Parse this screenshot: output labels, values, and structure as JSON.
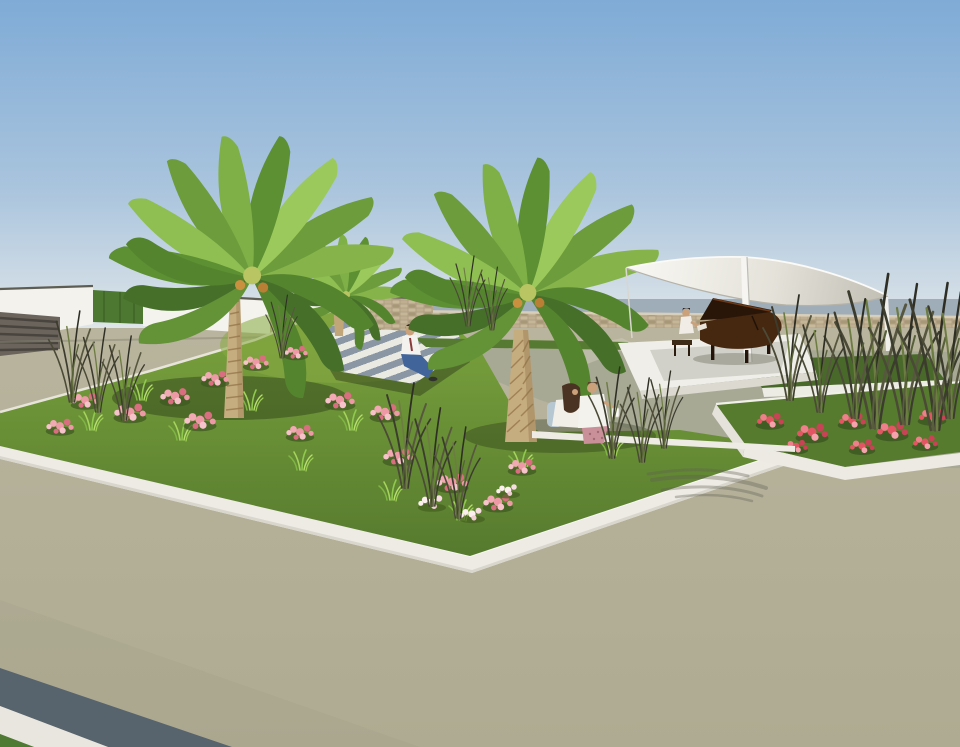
{
  "meta": {
    "kind": "3d-architectural-landscape-rendering",
    "setting": "Seaside public plaza with raised planters, palm trees and an open-air piano stage",
    "canvas": {
      "width": 960,
      "height": 747
    }
  },
  "palette": {
    "sky_top": "#7fabd6",
    "sky_horizon": "#e3e8ea",
    "sea": "#9fadb9",
    "wall_stone": "#b3a286",
    "pavement": "#b8b49d",
    "pavement_deep": "#afab92",
    "sage_ground": "#a7a995",
    "grass_light": "#7ca43e",
    "grass": "#567a2e",
    "grass_deep": "#49692a",
    "curb_white": "#edebe4",
    "curb_face": "#d9d7cd",
    "canopy_white": "#f7f6f1",
    "canopy_shadow": "#c3c0b6",
    "palm_trunk": "#c6ad80",
    "slate_band": "#57636d",
    "piano_brown": "#46270f",
    "hedge_green": "#4d7831",
    "building_white": "#f4f3ee",
    "step_light": "#ebeae2",
    "step_shadow": "#8b96a4",
    "flower_pink": "#ee9aa6",
    "flower_deep": "#d96e80",
    "flower_red": "#e25663",
    "flower_white": "#fdeef0",
    "skin": "#cba17b",
    "jeans": "#41659a",
    "backpack": "#b6c7d2",
    "shorts": "#c9909a",
    "dry_grass": "#3c3c2e"
  },
  "scene": {
    "sky": {
      "condition": "clear gradient sky"
    },
    "horizon": {
      "feature": "grey-blue sea band visible above the boundary wall"
    },
    "stone_wall": {
      "label": "low rubble stone boundary wall along the back of the plaza"
    },
    "left_buildings": {
      "building": "low white flat-roofed building",
      "hedge": "dark green hedge wall panel",
      "amphitheater": "dark tiered steps at far left"
    },
    "planters": [
      {
        "id": "main-planter",
        "desc": "large raised triangular lawn mound with white concrete curb, two date palms, pink flower drifts and terraced steps"
      },
      {
        "id": "stage-lawn",
        "desc": "narrow curbed grass strip behind the stage"
      },
      {
        "id": "right-flower-bed",
        "desc": "white-curbed bed with lawn, red-pink flowers and dry ornamental grasses"
      },
      {
        "id": "corner-bed",
        "desc": "grass sliver at extreme bottom-left corner beyond white curb and slate drainage band"
      }
    ],
    "palm_trees": {
      "count": 3,
      "type": "date palms",
      "note": "two large foreground palms, one smaller palm behind the mound"
    },
    "terraced_steps": {
      "desc": "wide striped steps climbing the mound",
      "stripes": "white treads with blue-grey shadow risers"
    },
    "canopy": {
      "type": "white tensile shade sail",
      "posts": 2
    },
    "stage": {
      "desc": "low white performance deck below the sail"
    },
    "piano": {
      "type": "grand piano",
      "lid": "open",
      "finish": "dark walnut"
    },
    "people": [
      {
        "id": "pianist",
        "pose": "seated on bench playing the grand piano",
        "clothing": "white top"
      },
      {
        "id": "man-on-steps",
        "pose": "sitting on the terraced steps",
        "clothing": "white shirt, dark tie, blue jeans"
      },
      {
        "id": "woman-with-backpack",
        "pose": "seated on the planter curb",
        "clothing": "white top, light blue backpack, long dark hair"
      },
      {
        "id": "man-with-cup",
        "pose": "seated on the planter curb holding a white cup",
        "clothing": "white t-shirt, patterned pink shorts"
      }
    ],
    "vegetation": {
      "flowers": "drifts of pink and red lilies with some white clusters",
      "grasses": "tall dark dry grasses along beds and right foreground"
    }
  }
}
